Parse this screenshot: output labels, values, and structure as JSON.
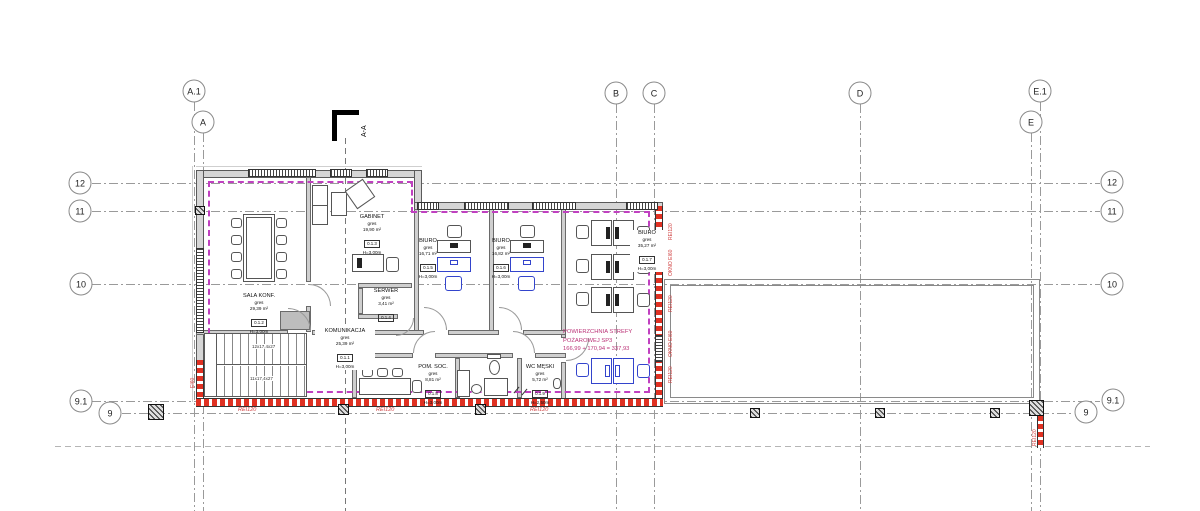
{
  "drawing": {
    "type": "architectural-floor-plan",
    "axes_columns": [
      "A.1",
      "A",
      "B",
      "C",
      "D",
      "E.1",
      "E"
    ],
    "axes_rows": [
      "12",
      "11",
      "10",
      "9.1",
      "9"
    ],
    "section_label": "A-A",
    "rooms": [
      {
        "name": "KOMUNIKACJA",
        "floor": "gres",
        "area": "25,39 m²",
        "tag": "0.1.1",
        "height": "H=3,00m"
      },
      {
        "name": "SALA KONF.",
        "floor": "gres",
        "area": "29,39 m²",
        "tag": "0.1.2",
        "height": "H=3,00m"
      },
      {
        "name": "GABINET",
        "floor": "gres",
        "area": "19,90 m²",
        "tag": "0.1.3",
        "height": "H=3,00m"
      },
      {
        "name": "SERWER",
        "floor": "gres",
        "area": "3,41 m²",
        "tag": "0.1.4",
        "height": "H=3,00m"
      },
      {
        "name": "BIURO",
        "floor": "gres",
        "area": "16,71 m²",
        "tag": "0.1.5",
        "height": "H=3,00m"
      },
      {
        "name": "BIURO",
        "floor": "gres",
        "area": "16,82 m²",
        "tag": "0.1.6",
        "height": "H=3,00m"
      },
      {
        "name": "BIURO",
        "floor": "gres",
        "area": "35,27 m²",
        "tag": "0.1.7",
        "height": "H=3,00m"
      },
      {
        "name": "POM. SOC.",
        "floor": "gres",
        "area": "8,81 m²",
        "tag": "0.1.8",
        "height": "H=3,00m"
      },
      {
        "name": "WC MĘSKI",
        "floor": "gres",
        "area": "5,72 m²",
        "tag": "0.1.9",
        "height": "H=2,50m"
      }
    ],
    "fire_zone": {
      "line1": "POWIERZCHNIA STREFY",
      "line2": "POŻAROWEJ SP3",
      "line3": "166,99 + 170,94 = 337,93",
      "rei": "REI120",
      "okno": "OKNO EI60",
      "ei": "EI60"
    },
    "stairs": {
      "upper_flight": "12x17,4x27",
      "lower_flight": "11x17,4x27"
    },
    "colors": {
      "fire_red": "#e03122",
      "zone_magenta": "#c040c0",
      "annotation_red": "#d04040",
      "furniture_blue": "#3344cc"
    }
  }
}
